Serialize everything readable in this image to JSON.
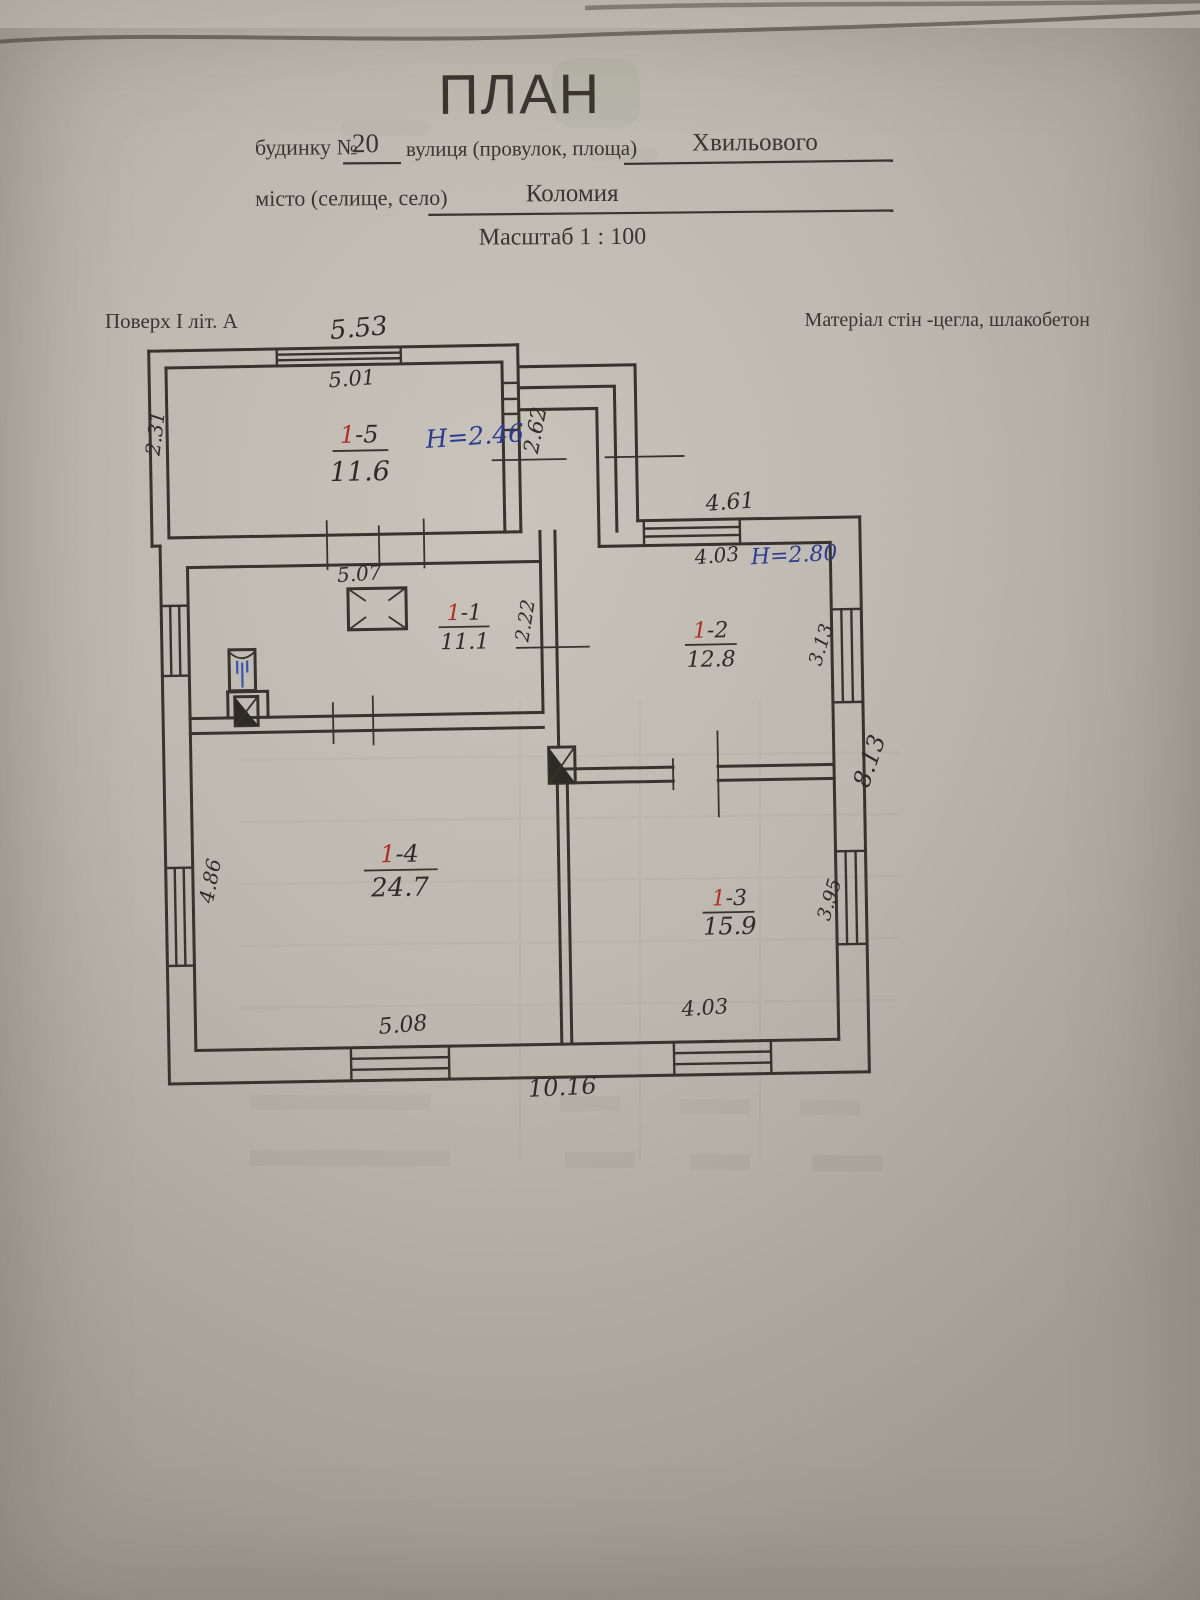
{
  "page": {
    "title": "ПЛАН",
    "form": {
      "house_label": "будинку  №",
      "house_number": "20",
      "street_label": "вулиця (провулок, площа)",
      "street_value": "Хвильового",
      "city_label": "місто (селище, село)",
      "city_value": "Коломия",
      "scale_line": "Масштаб  1 : 100"
    },
    "floor_note": "Поверх І  літ. А",
    "material_note": "Матеріал стін -цегла, шлакобетон"
  },
  "plan": {
    "rooms": [
      {
        "prefix": "1",
        "suffix": "-5",
        "area": "11.6",
        "height": "H=2.46"
      },
      {
        "prefix": "1",
        "suffix": "-1",
        "area": "11.1"
      },
      {
        "prefix": "1",
        "suffix": "-2",
        "area": "12.8",
        "height": "H=2.80"
      },
      {
        "prefix": "1",
        "suffix": "-4",
        "area": "24.7"
      },
      {
        "prefix": "1",
        "suffix": "-3",
        "area": "15.9"
      }
    ],
    "dimensions": {
      "top_overall": "5.53",
      "room5_width": "5.01",
      "room5_depth": "2.31",
      "porch_depth": "2.62",
      "right_top": "4.61",
      "room2_width": "4.03",
      "room1_width": "5.07",
      "room1_depth": "2.22",
      "room2_depth": "3.13",
      "right_overall": "8.13",
      "room4_depth": "4.86",
      "room3_depth": "3.95",
      "room4_width": "5.08",
      "room3_width": "4.03",
      "bottom_overall": "10.16"
    },
    "colors": {
      "ink": "#38332c",
      "handwriting": "#2f2b26",
      "blue_ink": "#2c3c92",
      "red_ink": "#b03026",
      "paper": "#beb9b0"
    }
  }
}
